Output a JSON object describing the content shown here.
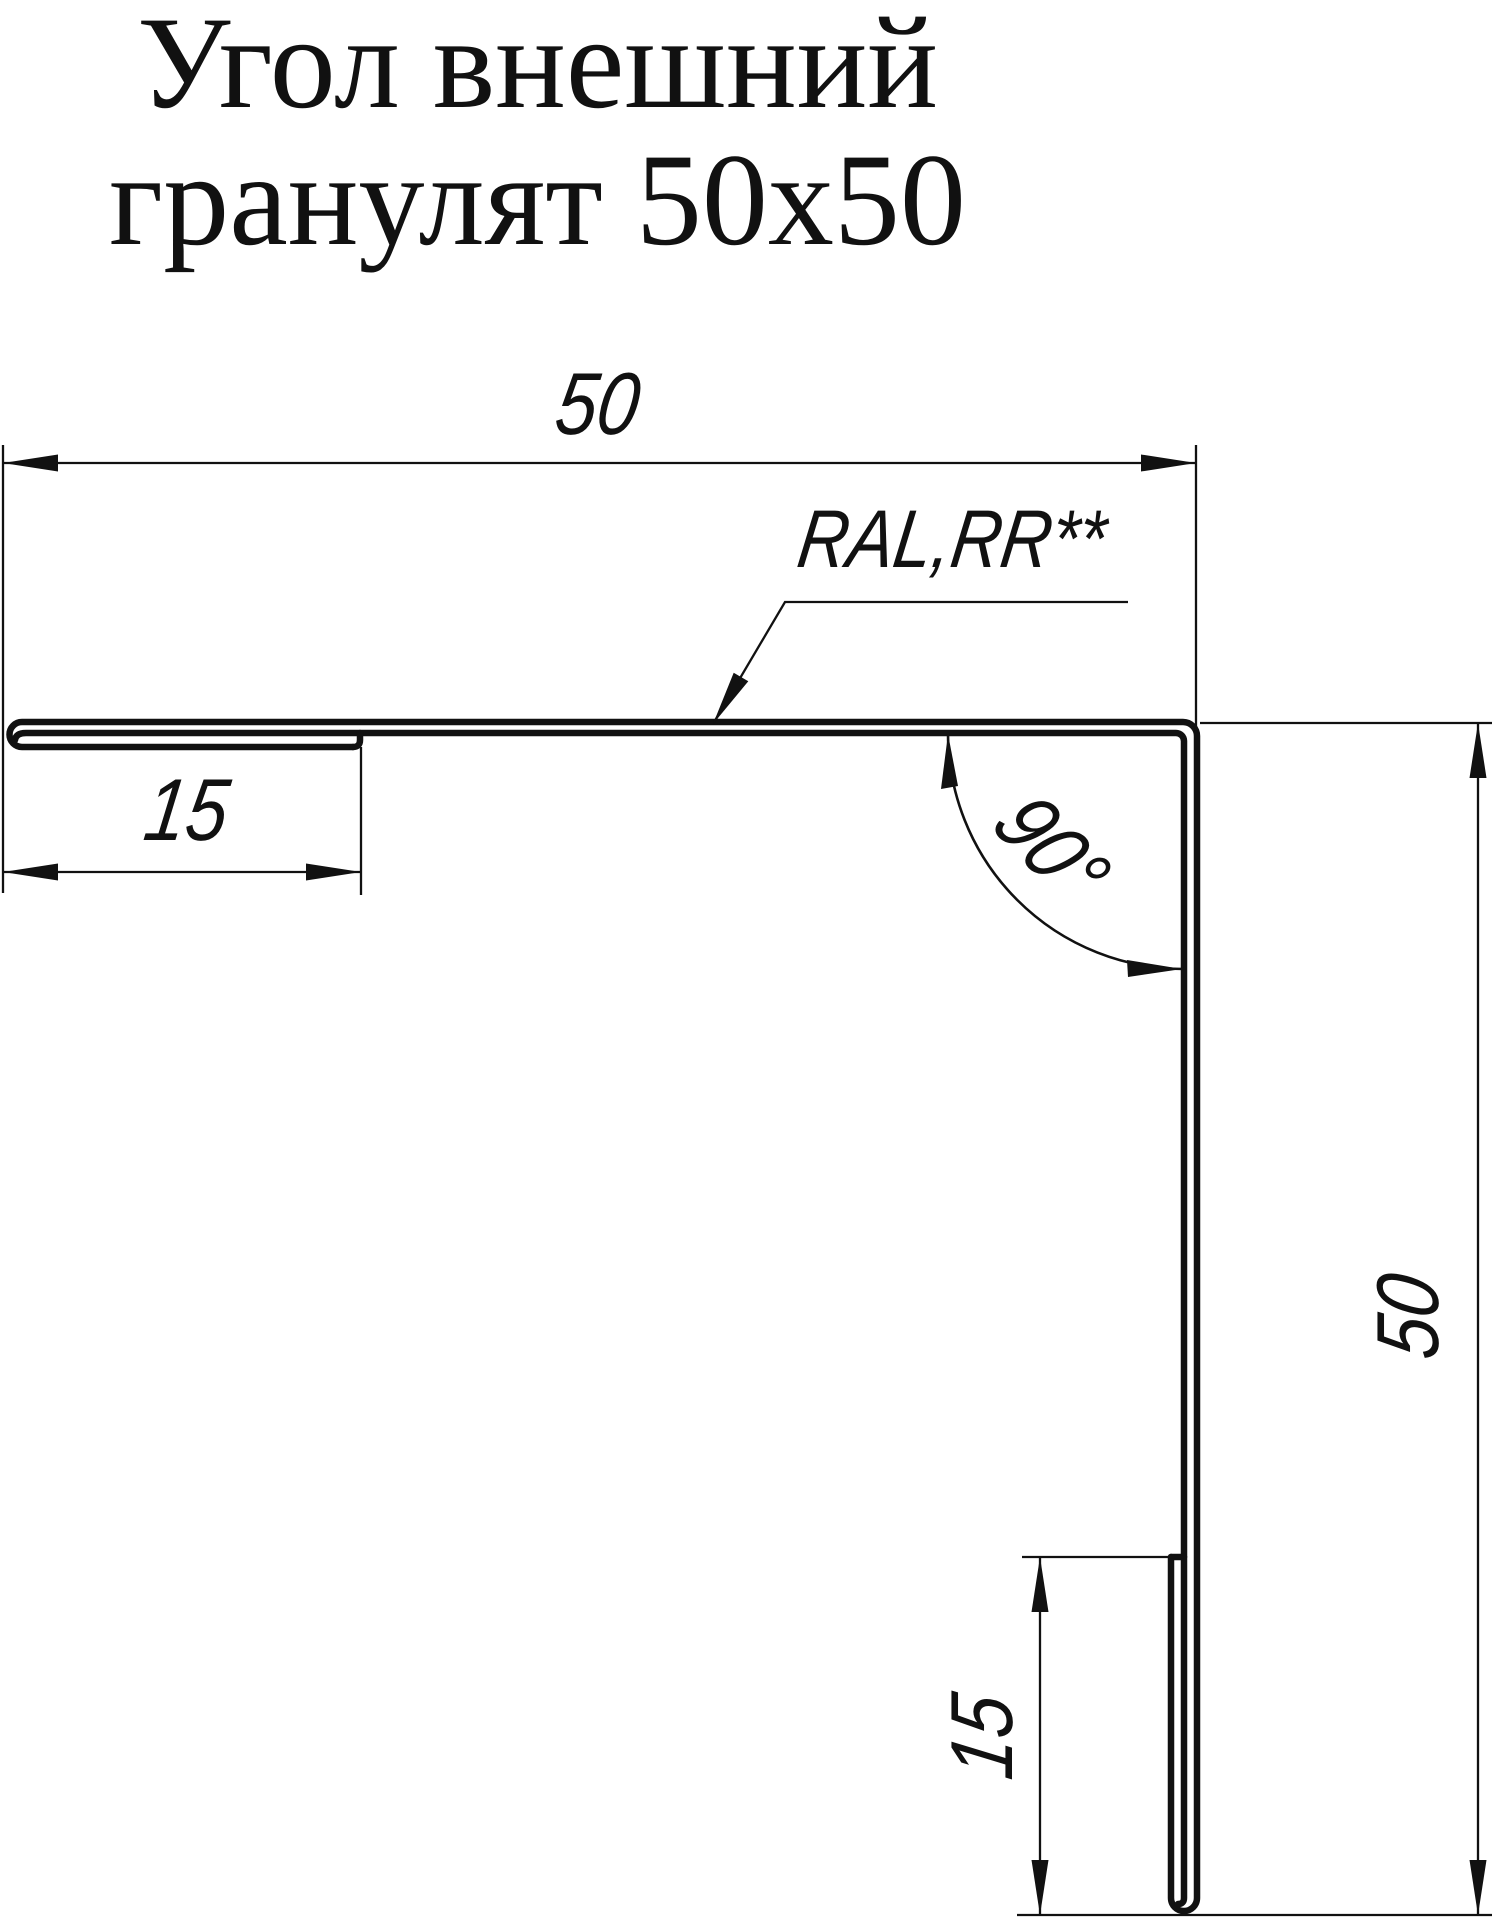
{
  "page": {
    "background": "#ffffff",
    "line_color": "#111111"
  },
  "title": {
    "line1": "Угол внешний",
    "line2": "гранулят 50x50"
  },
  "labels": {
    "coating": "RAL,RR**"
  },
  "dimensions": {
    "top_width": "50",
    "left_hem": "15",
    "right_height": "50",
    "bottom_hem": "15",
    "angle": "90°"
  }
}
